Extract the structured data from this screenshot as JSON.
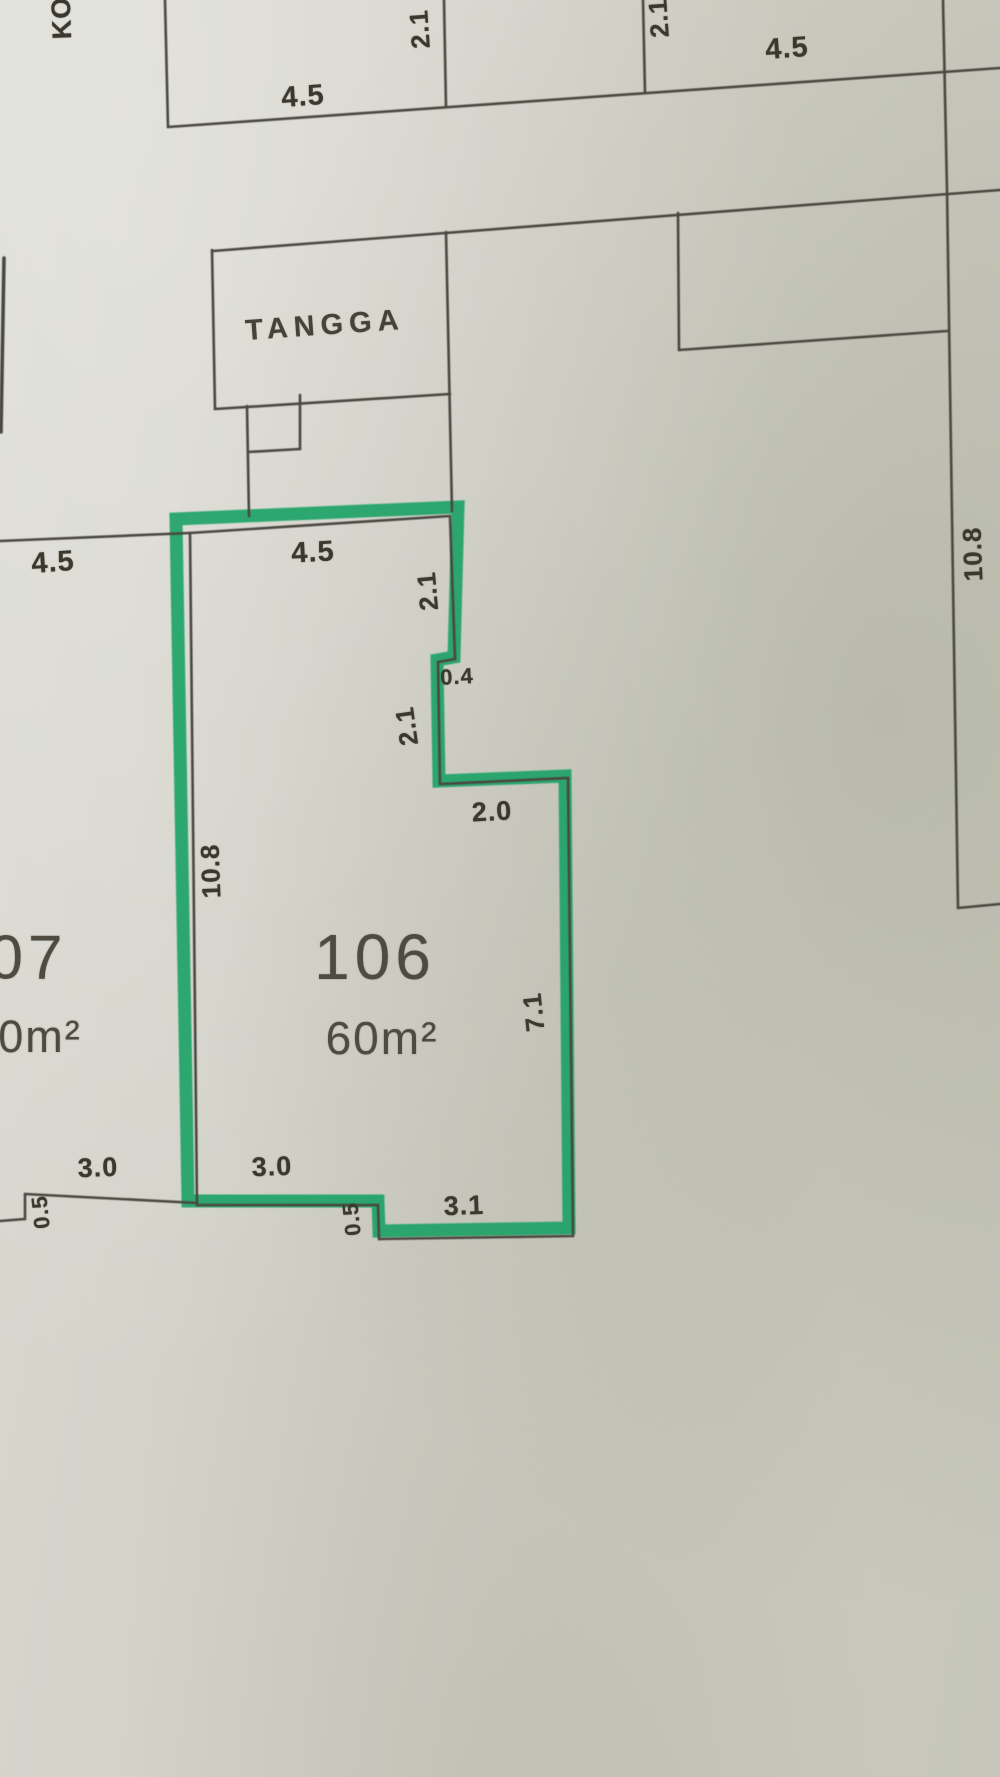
{
  "plan": {
    "unit_number": "106",
    "unit_area": "60m²",
    "adjacent_unit_number": "07",
    "adjacent_unit_area": "0m²",
    "stairwell_label": "TANGGA",
    "corridor_label": "KO",
    "highlight_color": "#19a164",
    "line_color": "#4a473f",
    "paper_color": "#d2d1c7",
    "dimensions": {
      "corridor_top_45": "4.5",
      "top_21_left": "2.1",
      "top_21_right": "2.1",
      "top_right_45": "4.5",
      "left_outside_45": "4.5",
      "unit_top_45": "4.5",
      "unit_right_upper_21": "2.1",
      "step_04": "0.4",
      "unit_right_mid_21": "2.1",
      "step_20": "2.0",
      "unit_left_108": "10.8",
      "right_wall_108": "10.8",
      "unit_right_71": "7.1",
      "bottom_left_30": "3.0",
      "bottom_left_05": "0.5",
      "unit_bottom_30": "3.0",
      "unit_bottom_05": "0.5",
      "unit_bottom_31": "3.1"
    }
  }
}
